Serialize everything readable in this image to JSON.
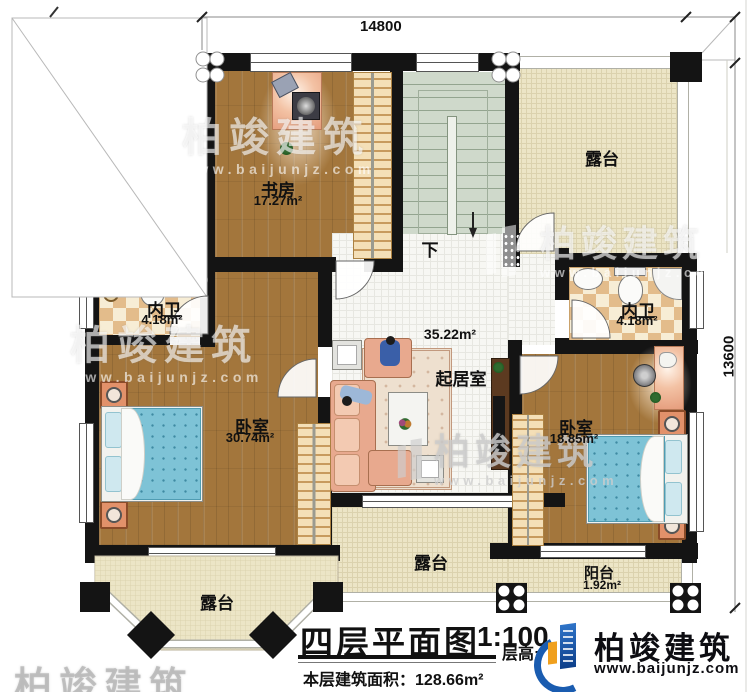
{
  "dimensions": {
    "top": "14800",
    "right": "13600"
  },
  "rooms": {
    "study": {
      "label": "书房",
      "area": "17.27m²"
    },
    "bath_left": {
      "label": "内卫",
      "area": "4.18m²"
    },
    "bath_right": {
      "label": "内卫",
      "area": "4.18m²"
    },
    "bedroom_left": {
      "label": "卧室",
      "area": "30.74m²"
    },
    "bedroom_right": {
      "label": "卧室",
      "area": "18.85m²"
    },
    "living": {
      "label": "起居室",
      "area": "35.22m²"
    },
    "terrace_top_right": {
      "label": "露台"
    },
    "terrace_bottom_left": {
      "label": "露台"
    },
    "terrace_bottom_center": {
      "label": "露台"
    },
    "balcony": {
      "label": "阳台",
      "area": "1.92m²"
    },
    "stairs": {
      "down_label": "下"
    }
  },
  "title_block": {
    "title": "四层平面图",
    "scale": "1:100",
    "floor_height_label": "层高:",
    "area_label": "本层建筑面积：",
    "area_value": "128.66m²"
  },
  "brand": {
    "name": "柏竣建筑",
    "website": "www.baijunjz.com"
  },
  "colors": {
    "wall": "#141414",
    "wood_floor": "#a3763c",
    "terrace_floor": "#ece5c6",
    "stair_floor": "#cfd9cb",
    "bath_tile_dark": "#e3bc8b",
    "bed_blue": "#7ec3d6",
    "sofa_salmon": "#e8a98e",
    "brand_blue": "#1a5cb0",
    "brand_orange": "#f0a01e"
  }
}
